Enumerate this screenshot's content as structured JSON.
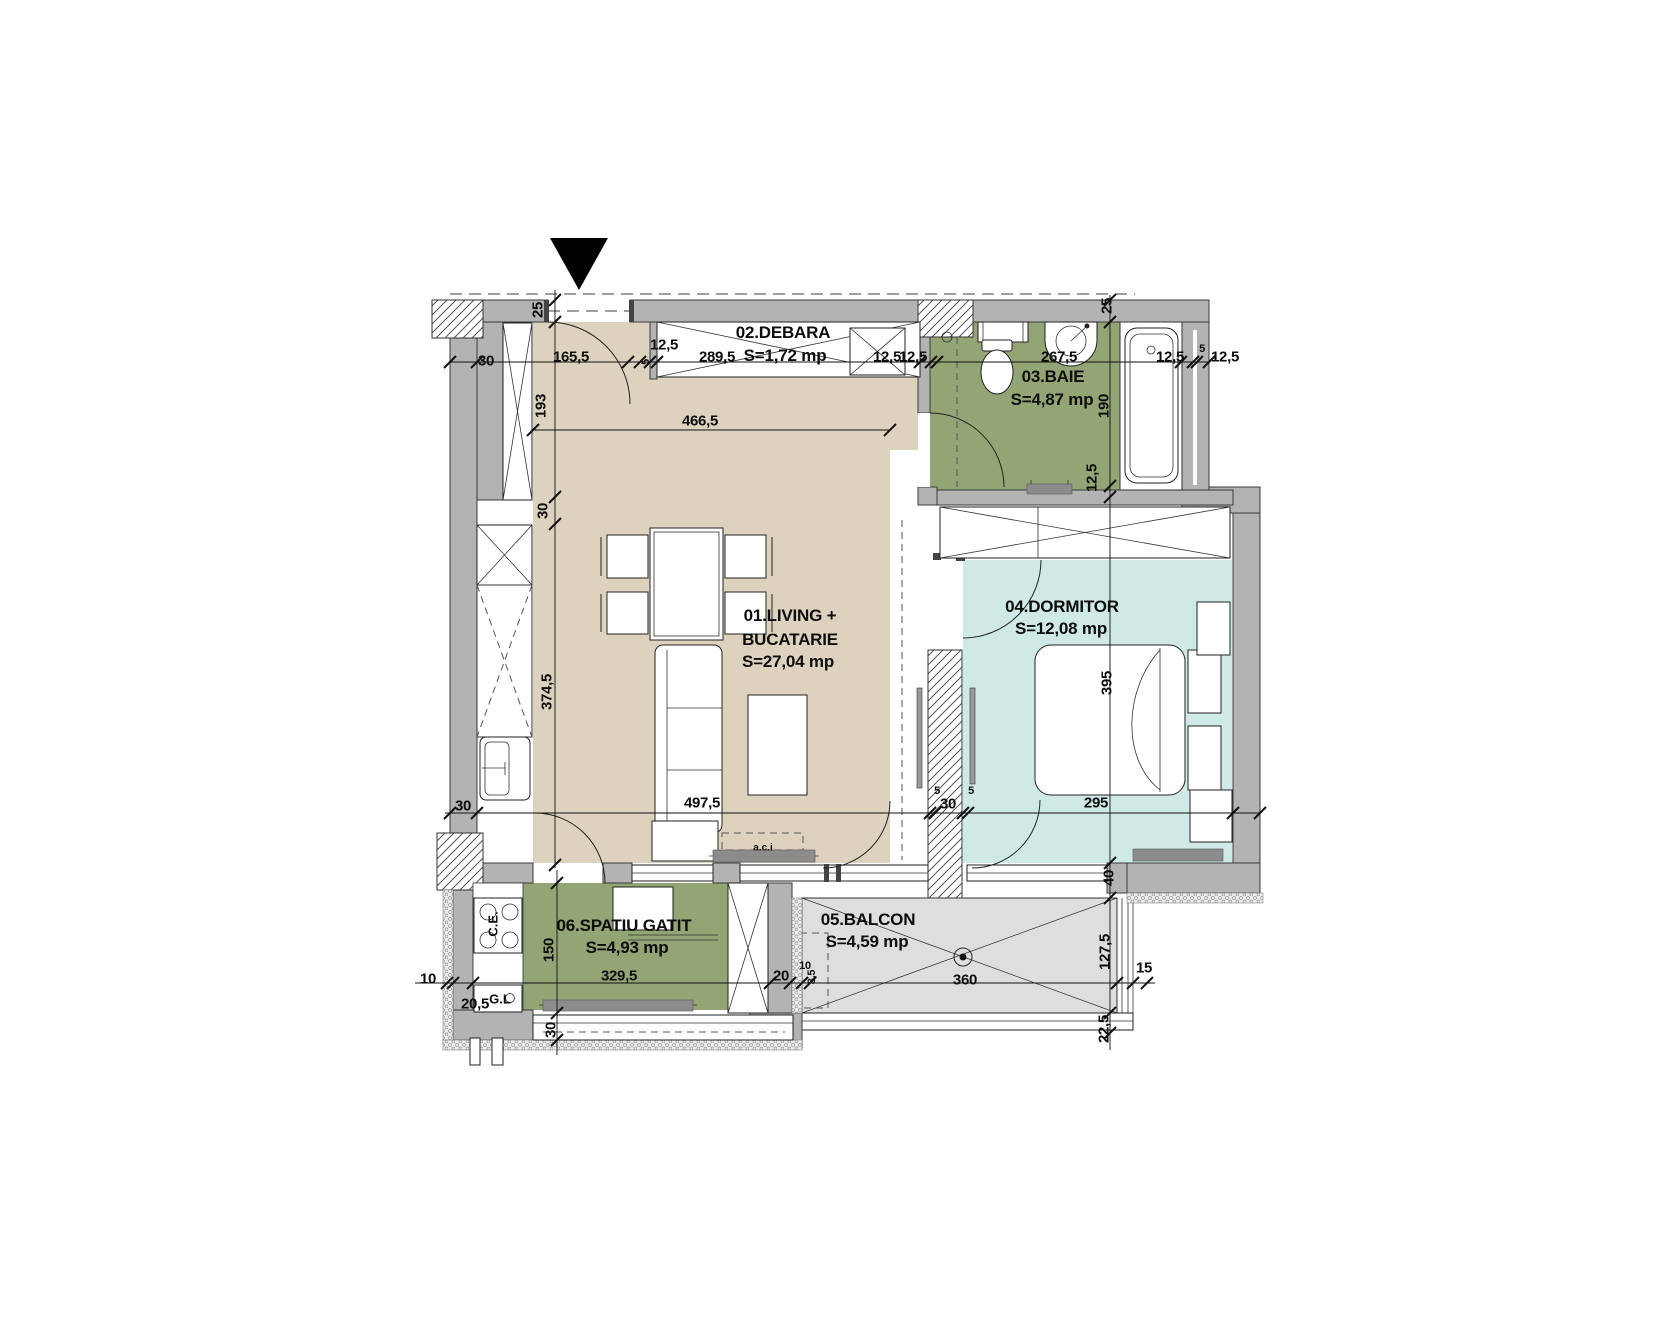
{
  "plan": {
    "colors": {
      "living": "#ddd2bd",
      "service": "#93a475",
      "bedroom": "#cfe9e7",
      "balcony": "#dedede",
      "wall": "#b3b3b3"
    },
    "rooms": [
      {
        "name": "01.LIVING +",
        "name2": "BUCATARIE",
        "area": "S=27,04 mp"
      },
      {
        "name": "02.DEBARA",
        "area": "S=1,72 mp"
      },
      {
        "name": "03.BAIE",
        "area": "S=4,87 mp"
      },
      {
        "name": "04.DORMITOR",
        "area": "S=12,08 mp"
      },
      {
        "name": "05.BALCON",
        "area": "S=4,59 mp"
      },
      {
        "name": "06.SPATIU GATIT",
        "area": "S=4,93 mp"
      }
    ],
    "annotations": [
      {
        "t": "a.c.i",
        "x": 763,
        "y": 848,
        "s": 1
      },
      {
        "t": "C.E.",
        "x": 493,
        "y": 924,
        "r": 1
      },
      {
        "t": "G.L",
        "x": 500,
        "y": 999
      }
    ],
    "dims": [
      {
        "t": "30",
        "x": 486,
        "y": 361
      },
      {
        "t": "165,5",
        "x": 571,
        "y": 357
      },
      {
        "t": "12,5",
        "x": 664,
        "y": 345
      },
      {
        "t": "5",
        "x": 646,
        "y": 362,
        "r": 1,
        "s": 1
      },
      {
        "t": "289,5",
        "x": 717,
        "y": 357
      },
      {
        "t": "12,5",
        "x": 887,
        "y": 357
      },
      {
        "t": "12,5",
        "x": 913,
        "y": 357
      },
      {
        "t": "267,5",
        "x": 1059,
        "y": 357
      },
      {
        "t": "12,5",
        "x": 1170,
        "y": 357
      },
      {
        "t": "5",
        "x": 1202,
        "y": 349,
        "s": 1
      },
      {
        "t": "12,5",
        "x": 1225,
        "y": 357
      },
      {
        "t": "25",
        "x": 538,
        "y": 310,
        "r": 1
      },
      {
        "t": "193",
        "x": 541,
        "y": 406,
        "r": 1
      },
      {
        "t": "30",
        "x": 543,
        "y": 511,
        "r": 1
      },
      {
        "t": "374,5",
        "x": 547,
        "y": 692,
        "r": 1
      },
      {
        "t": "25",
        "x": 1107,
        "y": 306,
        "r": 1
      },
      {
        "t": "190",
        "x": 1104,
        "y": 406,
        "r": 1
      },
      {
        "t": "12,5",
        "x": 1092,
        "y": 478,
        "r": 1
      },
      {
        "t": "395",
        "x": 1107,
        "y": 683,
        "r": 1
      },
      {
        "t": "40",
        "x": 1109,
        "y": 878,
        "r": 1
      },
      {
        "t": "127,5",
        "x": 1105,
        "y": 952,
        "r": 1
      },
      {
        "t": "22,5",
        "x": 1104,
        "y": 1029,
        "r": 1
      },
      {
        "t": "466,5",
        "x": 700,
        "y": 421
      },
      {
        "t": "497,5",
        "x": 702,
        "y": 803
      },
      {
        "t": "30",
        "x": 463,
        "y": 806
      },
      {
        "t": "5",
        "x": 937,
        "y": 791,
        "s": 1
      },
      {
        "t": "30",
        "x": 948,
        "y": 804
      },
      {
        "t": "5",
        "x": 971,
        "y": 791,
        "s": 1
      },
      {
        "t": "295",
        "x": 1096,
        "y": 803
      },
      {
        "t": "10",
        "x": 428,
        "y": 979
      },
      {
        "t": "20,5",
        "x": 475,
        "y": 1004
      },
      {
        "t": "150",
        "x": 549,
        "y": 950,
        "r": 1
      },
      {
        "t": "329,5",
        "x": 619,
        "y": 976
      },
      {
        "t": "20",
        "x": 781,
        "y": 976
      },
      {
        "t": "10",
        "x": 805,
        "y": 966,
        "s": 1
      },
      {
        "t": "8,5",
        "x": 812,
        "y": 977,
        "r": 1,
        "s": 1
      },
      {
        "t": "360",
        "x": 965,
        "y": 980
      },
      {
        "t": "15",
        "x": 1144,
        "y": 968
      },
      {
        "t": "30",
        "x": 551,
        "y": 1030,
        "r": 1
      }
    ]
  }
}
